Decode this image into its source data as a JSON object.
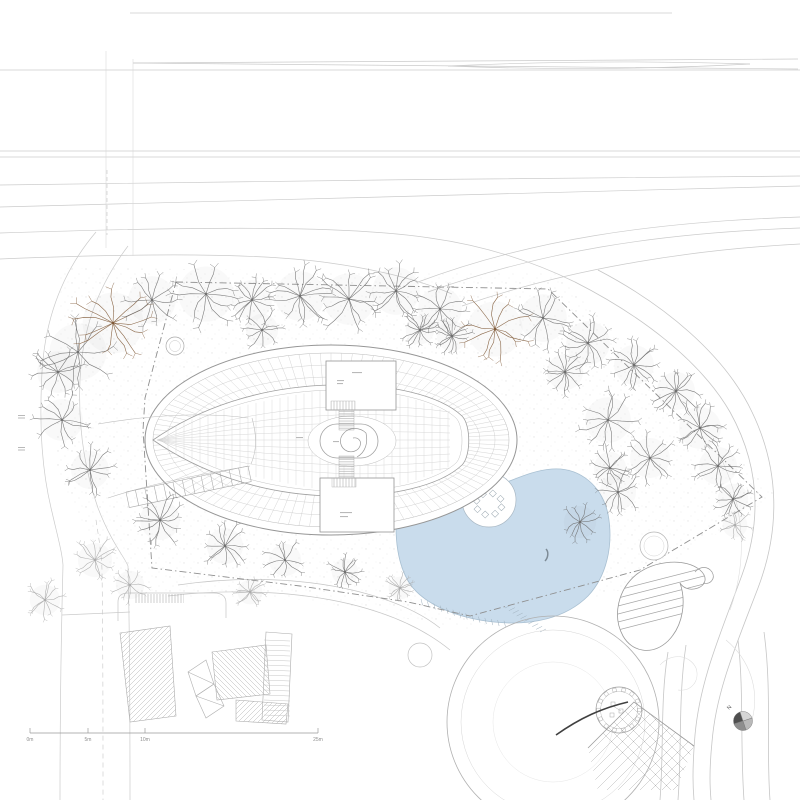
{
  "palette": {
    "line_faint": "#dcdcdc",
    "line_light": "#cbcbcb",
    "line_mid": "#b0b0b0",
    "line_dark": "#8f8f8f",
    "building_edge": "#969696",
    "panel_line": "#c9c9c9",
    "hatch_line": "#b5b5b5",
    "asphalt_accent": "#404040",
    "stipple": "#9a9a9a",
    "north_dark": "#4f4f4f",
    "north_mid": "#8d8d8d",
    "north_midlight": "#b9b9b9",
    "north_light": "#d6d6d6",
    "north_label_color": "#5a5a5a",
    "scale_text": "#8f8f8f"
  },
  "scale_bar": {
    "labels": [
      "0m",
      "5m",
      "10m",
      "25m"
    ],
    "tick_x": [
      30,
      88,
      145,
      318
    ],
    "y": 733
  },
  "north_arrow": {
    "label": "N",
    "cx": 743,
    "cy": 721,
    "r": 9.5
  },
  "site": {
    "boundary_points": "176,282 548,289 762,497 640,570 470,616 408,602 300,586 152,568 143,430 145,398",
    "pond": {
      "fill": "#c9dcec",
      "edge": "#a9c0d2",
      "deck_edge": "#9fb0bd"
    },
    "tree_colors": {
      "gray": "#6e6e6e",
      "brown": "#7d5634",
      "light": "#ababab"
    },
    "trees": [
      [
        78,
        352,
        30,
        "gray"
      ],
      [
        113,
        323,
        32,
        "brown"
      ],
      [
        152,
        300,
        25,
        "gray"
      ],
      [
        206,
        294,
        29,
        "gray"
      ],
      [
        252,
        300,
        21,
        "gray"
      ],
      [
        300,
        296,
        26,
        "gray"
      ],
      [
        349,
        299,
        27,
        "gray"
      ],
      [
        396,
        291,
        25,
        "gray"
      ],
      [
        440,
        309,
        23,
        "gray"
      ],
      [
        452,
        336,
        16,
        "gray"
      ],
      [
        495,
        329,
        29,
        "brown"
      ],
      [
        543,
        318,
        25,
        "gray"
      ],
      [
        588,
        343,
        23,
        "gray"
      ],
      [
        634,
        365,
        21,
        "gray"
      ],
      [
        676,
        391,
        20,
        "gray"
      ],
      [
        700,
        428,
        22,
        "gray"
      ],
      [
        718,
        466,
        20,
        "gray"
      ],
      [
        733,
        499,
        16,
        "gray"
      ],
      [
        58,
        372,
        22,
        "gray"
      ],
      [
        62,
        420,
        22,
        "gray"
      ],
      [
        90,
        470,
        20,
        "gray"
      ],
      [
        160,
        520,
        21,
        "gray"
      ],
      [
        95,
        560,
        18,
        "light"
      ],
      [
        130,
        585,
        15,
        "light"
      ],
      [
        225,
        546,
        19,
        "gray"
      ],
      [
        285,
        560,
        17,
        "gray"
      ],
      [
        345,
        572,
        14,
        "gray"
      ],
      [
        400,
        588,
        12,
        "light"
      ],
      [
        262,
        330,
        17,
        "gray"
      ],
      [
        420,
        330,
        15,
        "gray"
      ],
      [
        565,
        372,
        19,
        "gray"
      ],
      [
        608,
        420,
        24,
        "gray"
      ],
      [
        650,
        458,
        21,
        "gray"
      ],
      [
        618,
        492,
        19,
        "gray"
      ],
      [
        580,
        522,
        17,
        "gray"
      ],
      [
        610,
        468,
        17,
        "gray"
      ],
      [
        735,
        525,
        13,
        "light"
      ],
      [
        45,
        600,
        16,
        "light"
      ],
      [
        250,
        592,
        13,
        "light"
      ]
    ]
  }
}
